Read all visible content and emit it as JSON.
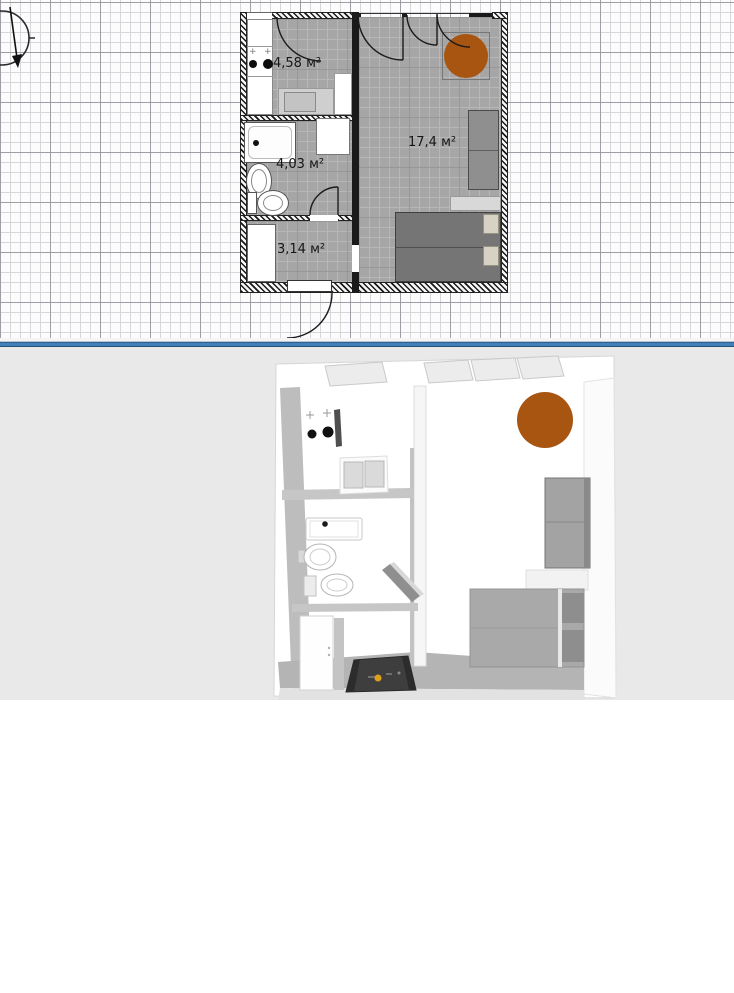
{
  "plan2d": {
    "rooms": [
      {
        "id": "kitchen",
        "area_label": "4,58 м²"
      },
      {
        "id": "bathroom",
        "area_label": "4,03 м²"
      },
      {
        "id": "hallway",
        "area_label": "3,14 м²"
      },
      {
        "id": "living-room",
        "area_label": "17,4 м²"
      }
    ],
    "furniture_icons": [
      "stove-icon",
      "kitchen-sink-icon",
      "bathtub-icon",
      "washbasin-icon",
      "toilet-icon",
      "washer-icon",
      "wardrobe-icon",
      "round-table-icon",
      "cabinet-icon",
      "shelf-icon",
      "double-bed-icon",
      "door-swing-arc-icon",
      "north-compass-icon"
    ]
  },
  "plan3d": {
    "furniture_icons": [
      "stove-burners-icon",
      "kitchen-counter-icon",
      "bathtub-icon",
      "washbasin-icon",
      "toilet-icon",
      "open-door-icon",
      "entrance-mat-icon",
      "round-table-icon",
      "wardrobe-icon",
      "shelf-icon",
      "double-bed-icon",
      "window-icon"
    ]
  },
  "watermark": {
    "icon": "house-in-brackets-icon",
    "letter": "М",
    "suffix": "ua"
  },
  "colors": {
    "divider_blue": "#3f80b8",
    "table_orange": "#a85511",
    "floor_gray": "#a6a6a6",
    "bed_gray": "#757575",
    "bottom_background": "#e9e9e9",
    "grid_major": "#9494a0",
    "grid_minor": "#d1d1d7"
  }
}
